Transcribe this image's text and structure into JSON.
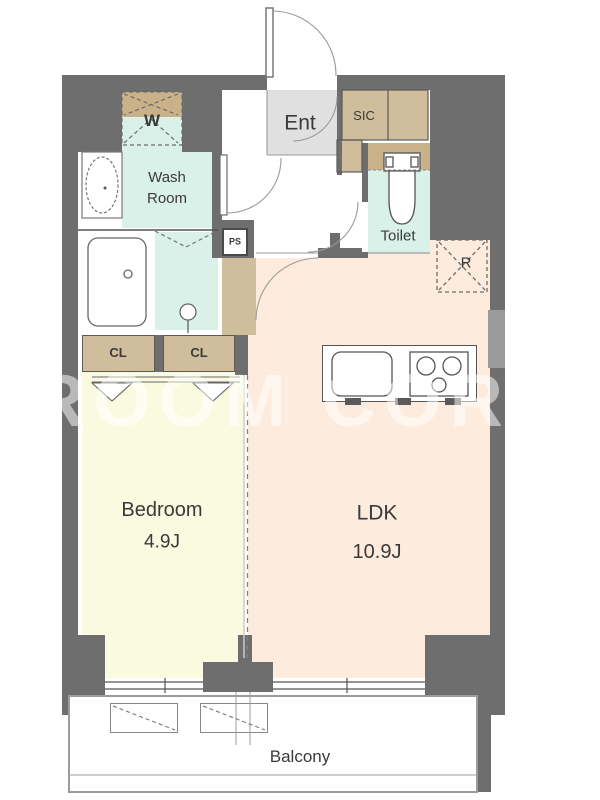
{
  "plan": {
    "watermark": "ROOM CORE",
    "rooms": {
      "entrance": "Ent",
      "washroom": "Wash\nRoom",
      "toilet": "Toilet",
      "bedroom": {
        "name": "Bedroom",
        "size": "4.9J"
      },
      "ldk": {
        "name": "LDK",
        "size": "10.9J"
      },
      "balcony": "Balcony"
    },
    "storage": {
      "washer_space": "W",
      "shoe_closet": "SIC",
      "pipe_space": "PS",
      "refrigerator_space": "R",
      "closet_left": "CL",
      "closet_right": "CL"
    },
    "colors": {
      "wall": "#6e6e6e",
      "wet_area": "#daf1ea",
      "closet": "#cfbd9b",
      "bedroom": "#fafae1",
      "ldk": "#fdecdd",
      "entrance_floor": "#e0e0e0"
    }
  }
}
